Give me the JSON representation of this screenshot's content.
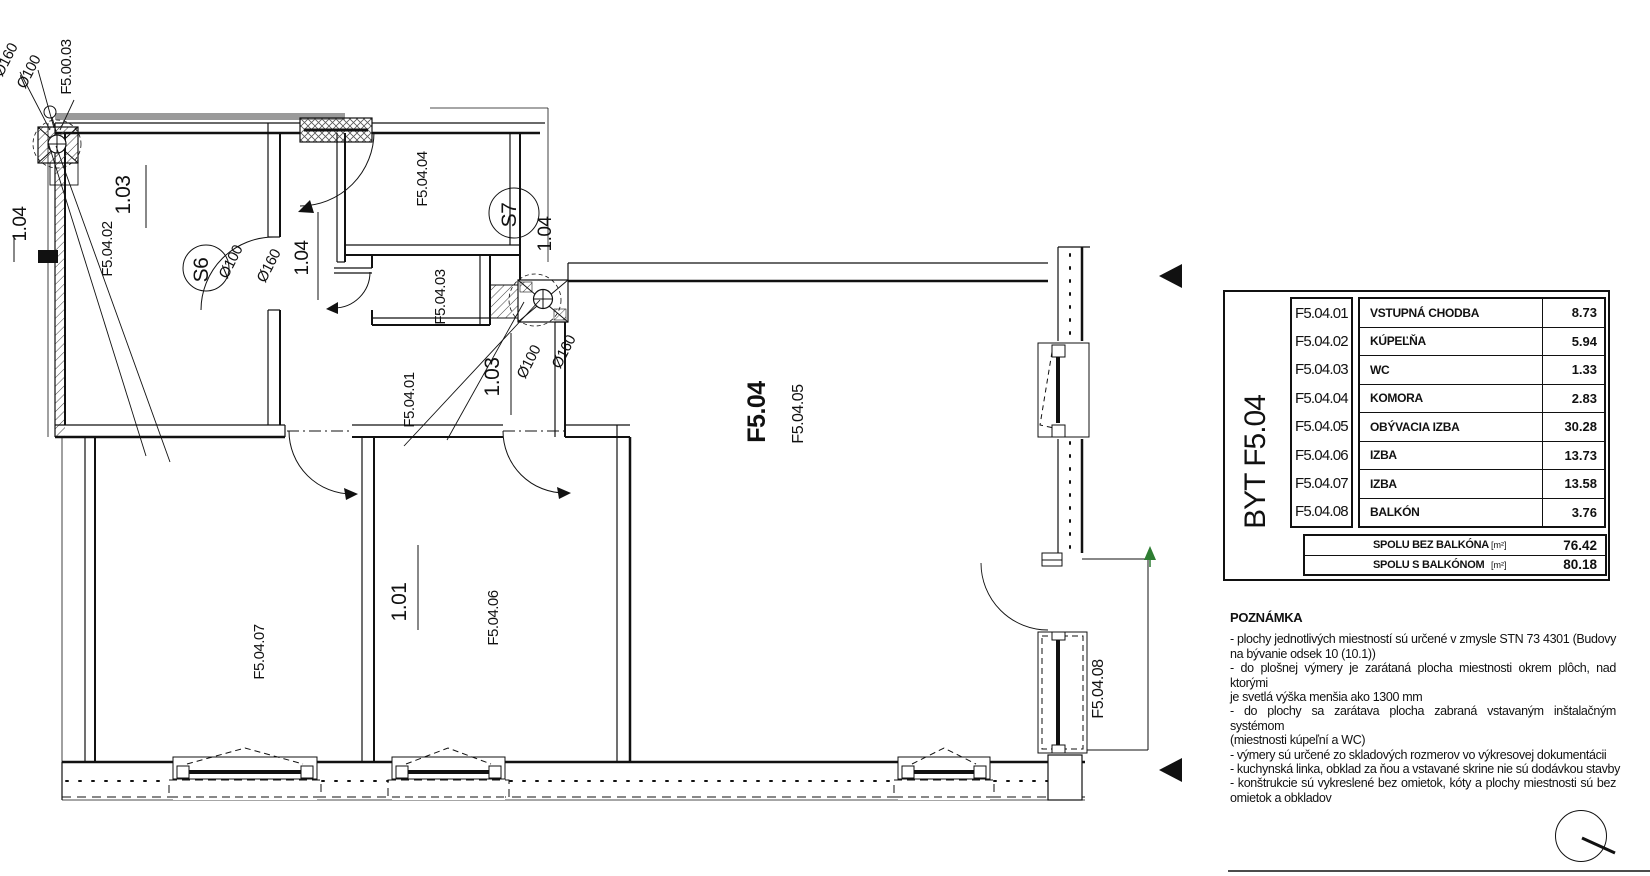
{
  "plan": {
    "labels": {
      "unit": "F5.04",
      "entry": "F5.04.01",
      "bathroom": "F5.04.02",
      "wc": "F5.04.03",
      "komora": "F5.04.04",
      "living": "F5.04.05",
      "izba_a": "F5.04.06",
      "izba_b": "F5.04.07",
      "balcony": "F5.04.08",
      "corridor_ref": "F5.00.03",
      "shaft_s6": "S6",
      "shaft_s7": "S7",
      "dia_100": "Ø100",
      "dia_160": "Ø160",
      "door_101": "1.01",
      "door_103": "1.03",
      "door_104": "1.04"
    }
  },
  "legend": {
    "unit_label": "BYT F5.04",
    "rows": [
      {
        "code": "F5.04.01",
        "name": "VSTUPNÁ CHODBA",
        "area": "8.73"
      },
      {
        "code": "F5.04.02",
        "name": "KÚPEĽŇA",
        "area": "5.94"
      },
      {
        "code": "F5.04.03",
        "name": "WC",
        "area": "1.33"
      },
      {
        "code": "F5.04.04",
        "name": "KOMORA",
        "area": "2.83"
      },
      {
        "code": "F5.04.05",
        "name": "OBÝVACIA IZBA",
        "area": "30.28"
      },
      {
        "code": "F5.04.06",
        "name": "IZBA",
        "area": "13.73"
      },
      {
        "code": "F5.04.07",
        "name": "IZBA",
        "area": "13.58"
      },
      {
        "code": "F5.04.08",
        "name": "BALKÓN",
        "area": "3.76"
      }
    ],
    "totals": [
      {
        "label": "SPOLU BEZ BALKÓNA",
        "unit": "[m²]",
        "value": "76.42"
      },
      {
        "label": "SPOLU S BALKÓNOM",
        "unit": "[m²]",
        "value": "80.18"
      }
    ]
  },
  "notes": {
    "title": "POZNÁMKA",
    "lines": [
      "- plochy jednotlivých miestností sú určené v zmysle STN 73 4301 (Budovy",
      "na bývanie odsek 10 (10.1))",
      "- do plošnej výmery je zarátaná plocha miestnosti okrem plôch, nad ktorými",
      "je svetlá výška menšia ako 1300 mm",
      "- do plochy sa zarátava plocha zabraná vstavaným inštalačným systémom",
      "(miestnosti kúpeľní a WC)",
      "- výmery sú určené zo skladových rozmerov vo výkresovej dokumentácii",
      "- kuchynská linka, obklad za ňou a vstavané skrine nie sú dodávkou stavby",
      "- konštrukcie sú vykreslené bez omietok, kóty a plochy miestnosti sú bez",
      "omietok a obkladov"
    ]
  }
}
